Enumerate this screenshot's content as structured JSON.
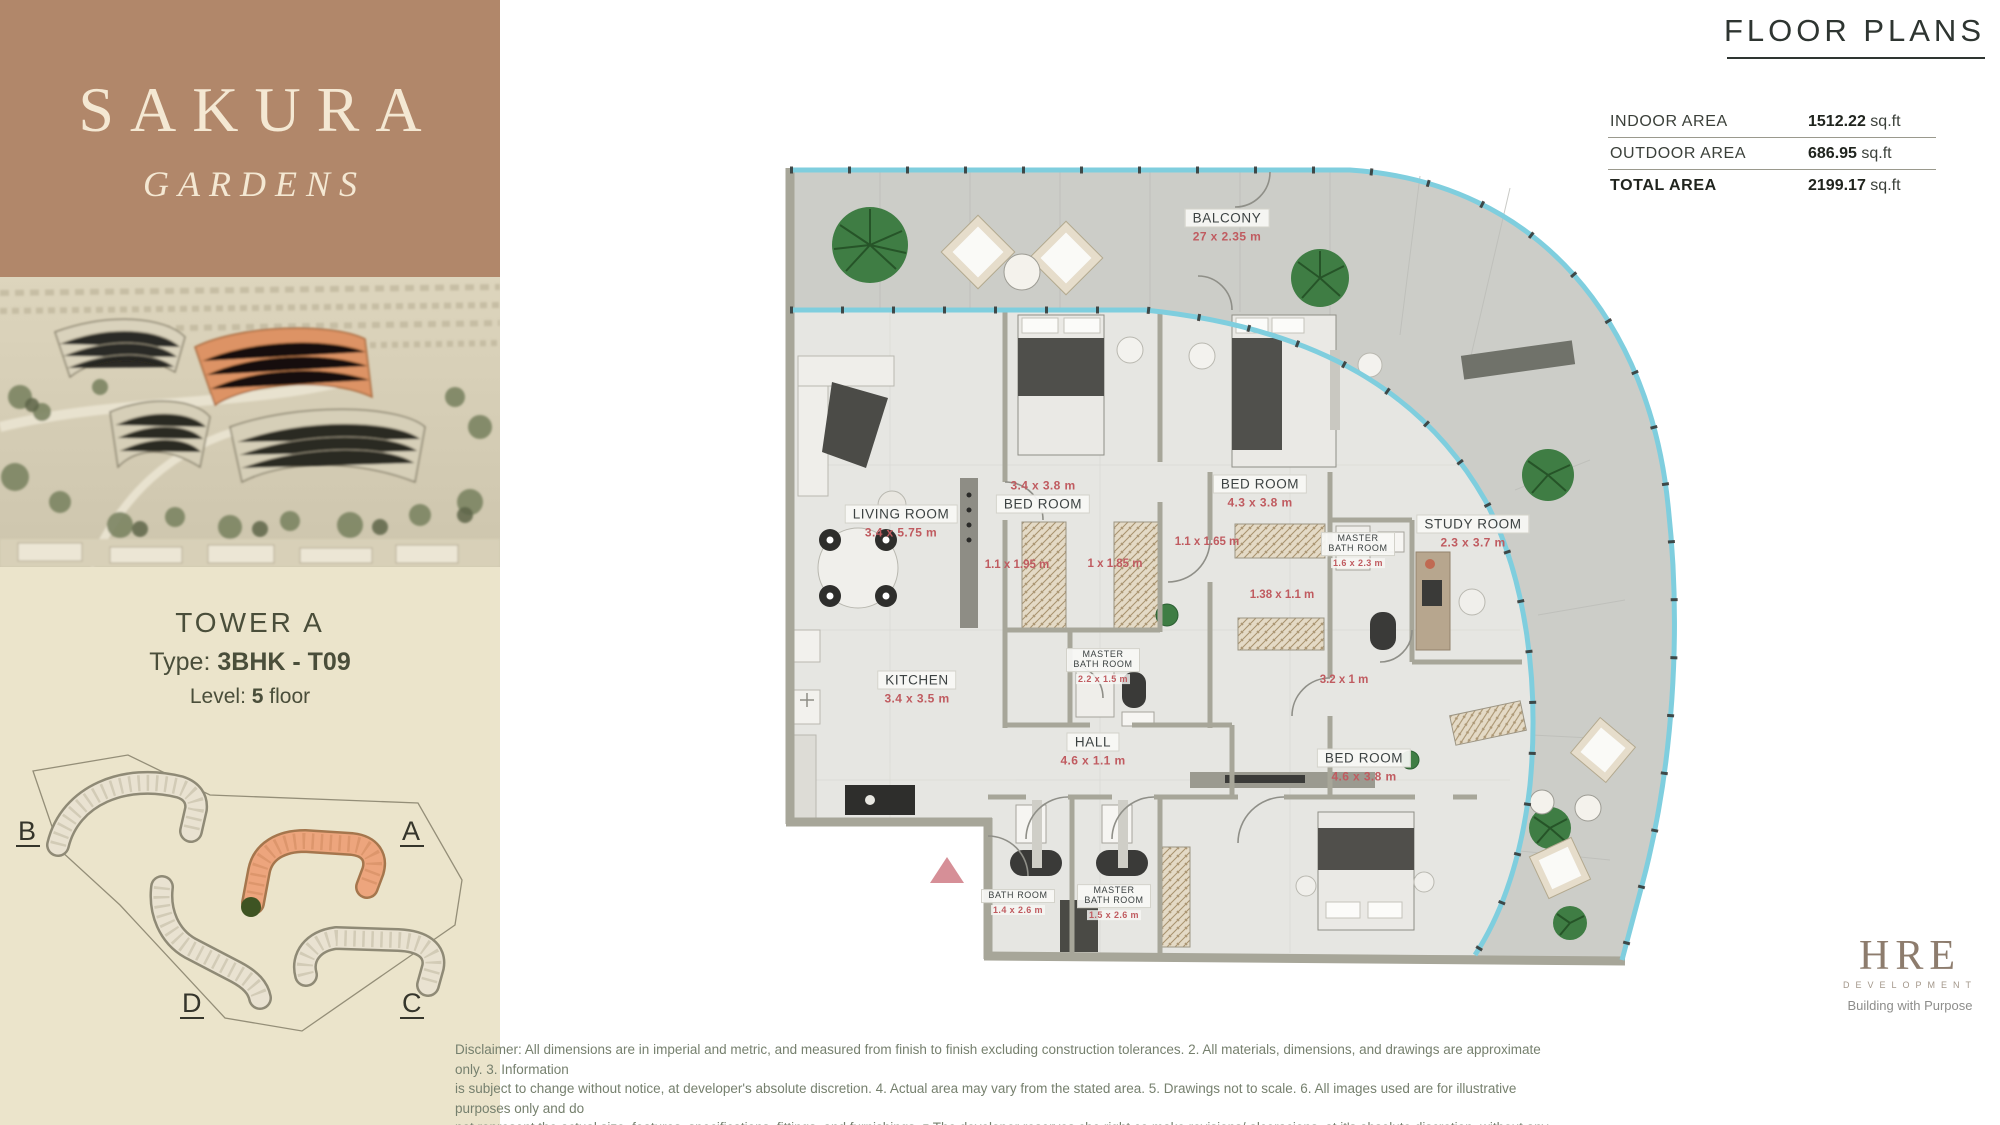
{
  "brand": {
    "title": "SAKURA",
    "subtitle": "GARDENS"
  },
  "unit": {
    "tower_label": "TOWER",
    "tower_value": "A",
    "type_label": "Type:",
    "type_value": "3BHK - T09",
    "level_label": "Level:",
    "level_value": "5",
    "level_suffix": "floor"
  },
  "site_map": {
    "labels": {
      "a": "A",
      "b": "B",
      "c": "C",
      "d": "D"
    }
  },
  "header": {
    "title": "FLOOR PLANS"
  },
  "area_table": {
    "rows": [
      {
        "label": "INDOOR AREA",
        "value": "1512.22",
        "unit": "sq.ft"
      },
      {
        "label": "OUTDOOR AREA",
        "value": "686.95",
        "unit": "sq.ft"
      },
      {
        "label": "TOTAL AREA",
        "value": "2199.17",
        "unit": "sq.ft"
      }
    ]
  },
  "plan": {
    "rooms": [
      {
        "name": "BALCONY",
        "dim": "27 x 2.35 m"
      },
      {
        "name": "LIVING ROOM",
        "dim": "3.4 x 5.75 m"
      },
      {
        "name": "BED ROOM",
        "dim": "3.4 x 3.8 m"
      },
      {
        "name": "BED ROOM",
        "dim": "4.3 x 3.8 m"
      },
      {
        "name": "STUDY ROOM",
        "dim": "2.3 x 3.7 m"
      },
      {
        "name": "MASTER BATH ROOM",
        "dim": "1.6 x 2.3 m"
      },
      {
        "name": "MASTER BATH ROOM",
        "dim": "2.2 x 1.5 m"
      },
      {
        "name": "KITCHEN",
        "dim": "3.4 x 3.5 m"
      },
      {
        "name": "HALL",
        "dim": "4.6 x 1.1 m"
      },
      {
        "name": "BATH ROOM",
        "dim": "1.4 x 2.6 m"
      },
      {
        "name": "MASTER BATH ROOM",
        "dim": "1.5 x 2.6 m"
      },
      {
        "name": "BED ROOM",
        "dim": "4.6 x 3.8 m"
      }
    ],
    "extra_dims": [
      "1.1 x 1.95 m",
      "1 x 1.85 m",
      "1.1 x 1.65 m",
      "1.38 x 1.1 m",
      "3.2 x 1 m"
    ]
  },
  "disclaimer": {
    "line1": "Disclaimer: All dimensions are in imperial and metric, and measured from finish to finish excluding construction tolerances. 2. All materials, dimensions, and drawings are approximate only. 3. Information",
    "line2": "is subject to change without notice, at developer's absolute discretion. 4. Actual area may vary from the stated area. 5. Drawings not to scale. 6. All images used are for illustrative purposes only and do",
    "line3": "not represent the actual size, features, specifications, fittings, and furnishings. z The developer reserves che right co make revisions/ alceracions, at it's absolute discretion. without any liability whatsoever."
  },
  "logo": {
    "name": "HRE",
    "division": "DEVELOPMENT",
    "tagline": "Building with Purpose"
  }
}
